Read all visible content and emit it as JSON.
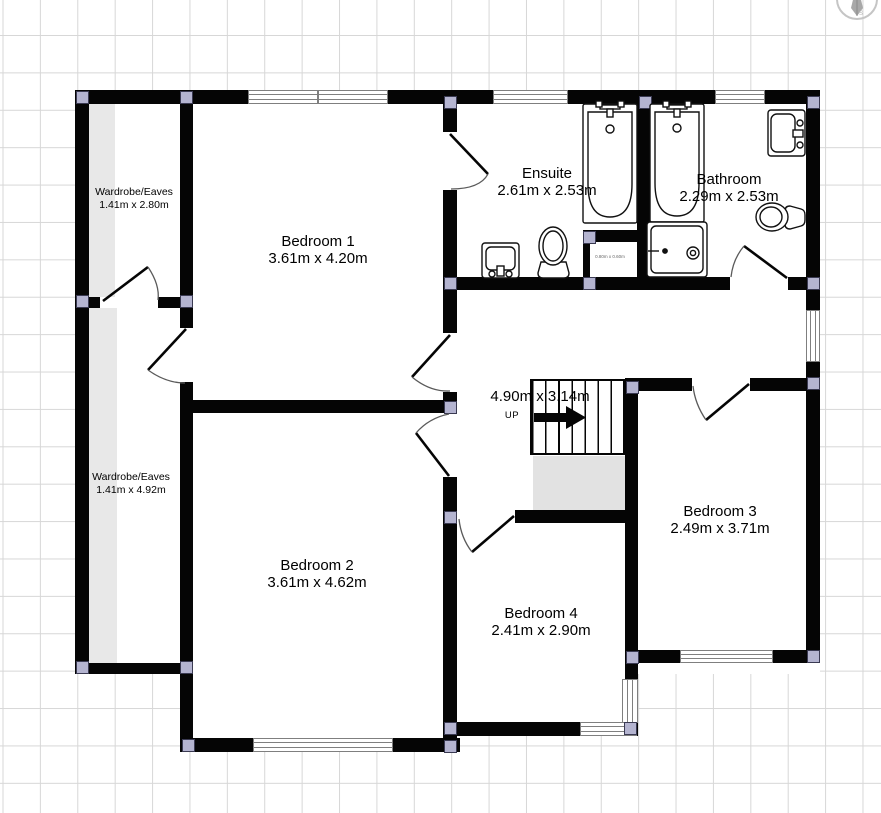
{
  "plan": {
    "title": "Upper floor plan",
    "rooms": [
      {
        "name": "Wardrobe/Eaves",
        "dims": "1.41m x 2.80m"
      },
      {
        "name": "Bedroom 1",
        "dims": "3.61m x 4.20m"
      },
      {
        "name": "Ensuite",
        "dims": "2.61m x 2.53m"
      },
      {
        "name": "Bathroom",
        "dims": "2.29m x 2.53m"
      },
      {
        "name": "Wardrobe/Eaves",
        "dims": "1.41m x 4.92m"
      },
      {
        "name": "Bedroom 2",
        "dims": "3.61m x 4.62m"
      },
      {
        "name": "Bedroom 4",
        "dims": "2.41m x 2.90m"
      },
      {
        "name": "Bedroom 3",
        "dims": "2.49m x 3.71m"
      }
    ],
    "cupboard": {
      "dims": "0.80m x 0.60m"
    },
    "landing": {
      "dims": "4.90m x 3.14m",
      "stair_direction": "UP"
    },
    "compass": {
      "south": "S"
    },
    "colors": {
      "wall": "#050505",
      "joint_handle": "#b4b4d0",
      "grid": "#d7d7d7",
      "eaves_shading": "#e8e8e8",
      "stair_void": "#e2e2e2",
      "window_frame": "#7f7f7f"
    }
  }
}
